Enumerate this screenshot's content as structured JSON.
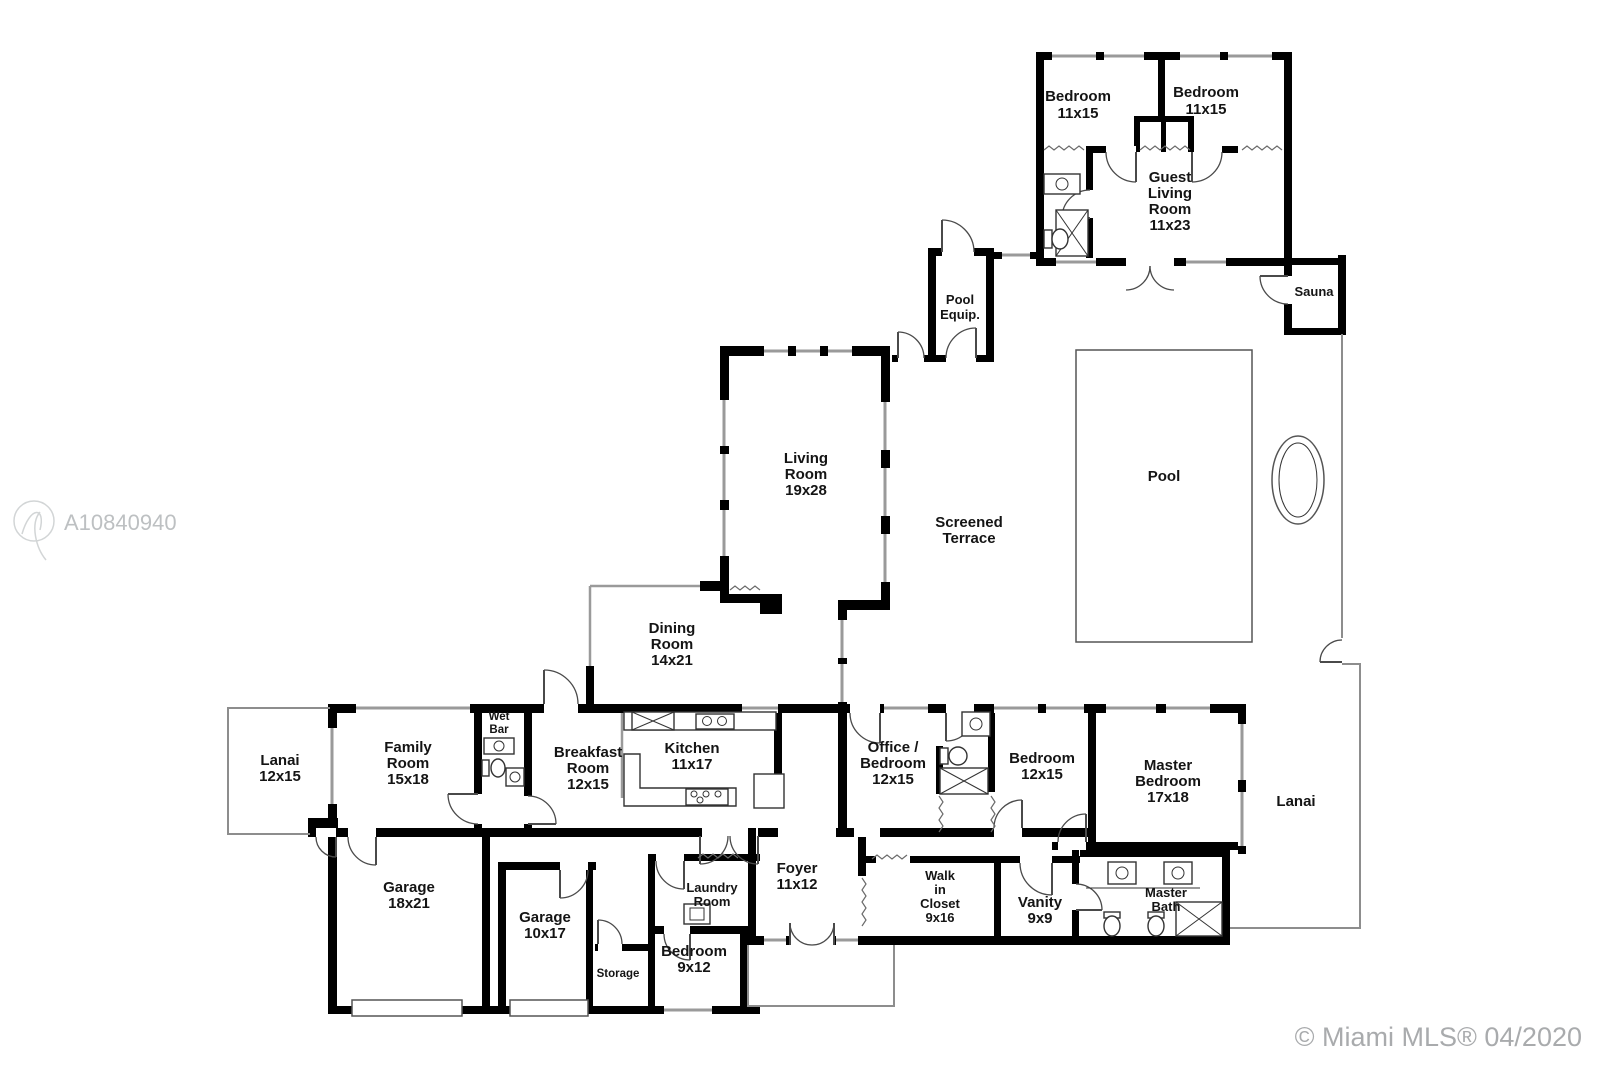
{
  "rooms": {
    "guest_bedroom_1": {
      "l1": "Bedroom",
      "l2": "11x15"
    },
    "guest_bedroom_2": {
      "l1": "Bedroom",
      "l2": "11x15"
    },
    "guest_living": {
      "l1": "Guest",
      "l2": "Living",
      "l3": "Room",
      "l4": "11x23"
    },
    "sauna": {
      "l1": "Sauna"
    },
    "pool_equip": {
      "l1": "Pool",
      "l2": "Equip."
    },
    "pool": {
      "l1": "Pool"
    },
    "screened_terrace": {
      "l1": "Screened",
      "l2": "Terrace"
    },
    "living_room": {
      "l1": "Living",
      "l2": "Room",
      "l3": "19x28"
    },
    "dining_room": {
      "l1": "Dining",
      "l2": "Room",
      "l3": "14x21"
    },
    "lanai_left": {
      "l1": "Lanai",
      "l2": "12x15"
    },
    "family_room": {
      "l1": "Family",
      "l2": "Room",
      "l3": "15x18"
    },
    "wet_bar": {
      "l1": "Wet",
      "l2": "Bar"
    },
    "breakfast_room": {
      "l1": "Breakfast",
      "l2": "Room",
      "l3": "12x15"
    },
    "kitchen": {
      "l1": "Kitchen",
      "l2": "11x17"
    },
    "office_bedroom": {
      "l1": "Office /",
      "l2": "Bedroom",
      "l3": "12x15"
    },
    "bedroom_12x15": {
      "l1": "Bedroom",
      "l2": "12x15"
    },
    "master_bedroom": {
      "l1": "Master",
      "l2": "Bedroom",
      "l3": "17x18"
    },
    "lanai_right": {
      "l1": "Lanai"
    },
    "garage_18x21": {
      "l1": "Garage",
      "l2": "18x21"
    },
    "garage_10x17": {
      "l1": "Garage",
      "l2": "10x17"
    },
    "storage": {
      "l1": "Storage"
    },
    "bedroom_9x12": {
      "l1": "Bedroom",
      "l2": "9x12"
    },
    "laundry_room": {
      "l1": "Laundry",
      "l2": "Room"
    },
    "foyer": {
      "l1": "Foyer",
      "l2": "11x12"
    },
    "walk_in_closet": {
      "l1": "Walk",
      "l2": "in",
      "l3": "Closet",
      "l4": "9x16"
    },
    "vanity": {
      "l1": "Vanity",
      "l2": "9x9"
    },
    "master_bath": {
      "l1": "Master",
      "l2": "Bath"
    }
  },
  "watermark": {
    "mls_id": "A10840940"
  },
  "footer": {
    "copyright": "© Miami MLS® 04/2020"
  },
  "colors": {
    "wall": "#000000",
    "window": "#9a9a9a",
    "screen": "#8d8d8d",
    "watermark": "#bdc0c2",
    "copyright": "#a9abad"
  }
}
